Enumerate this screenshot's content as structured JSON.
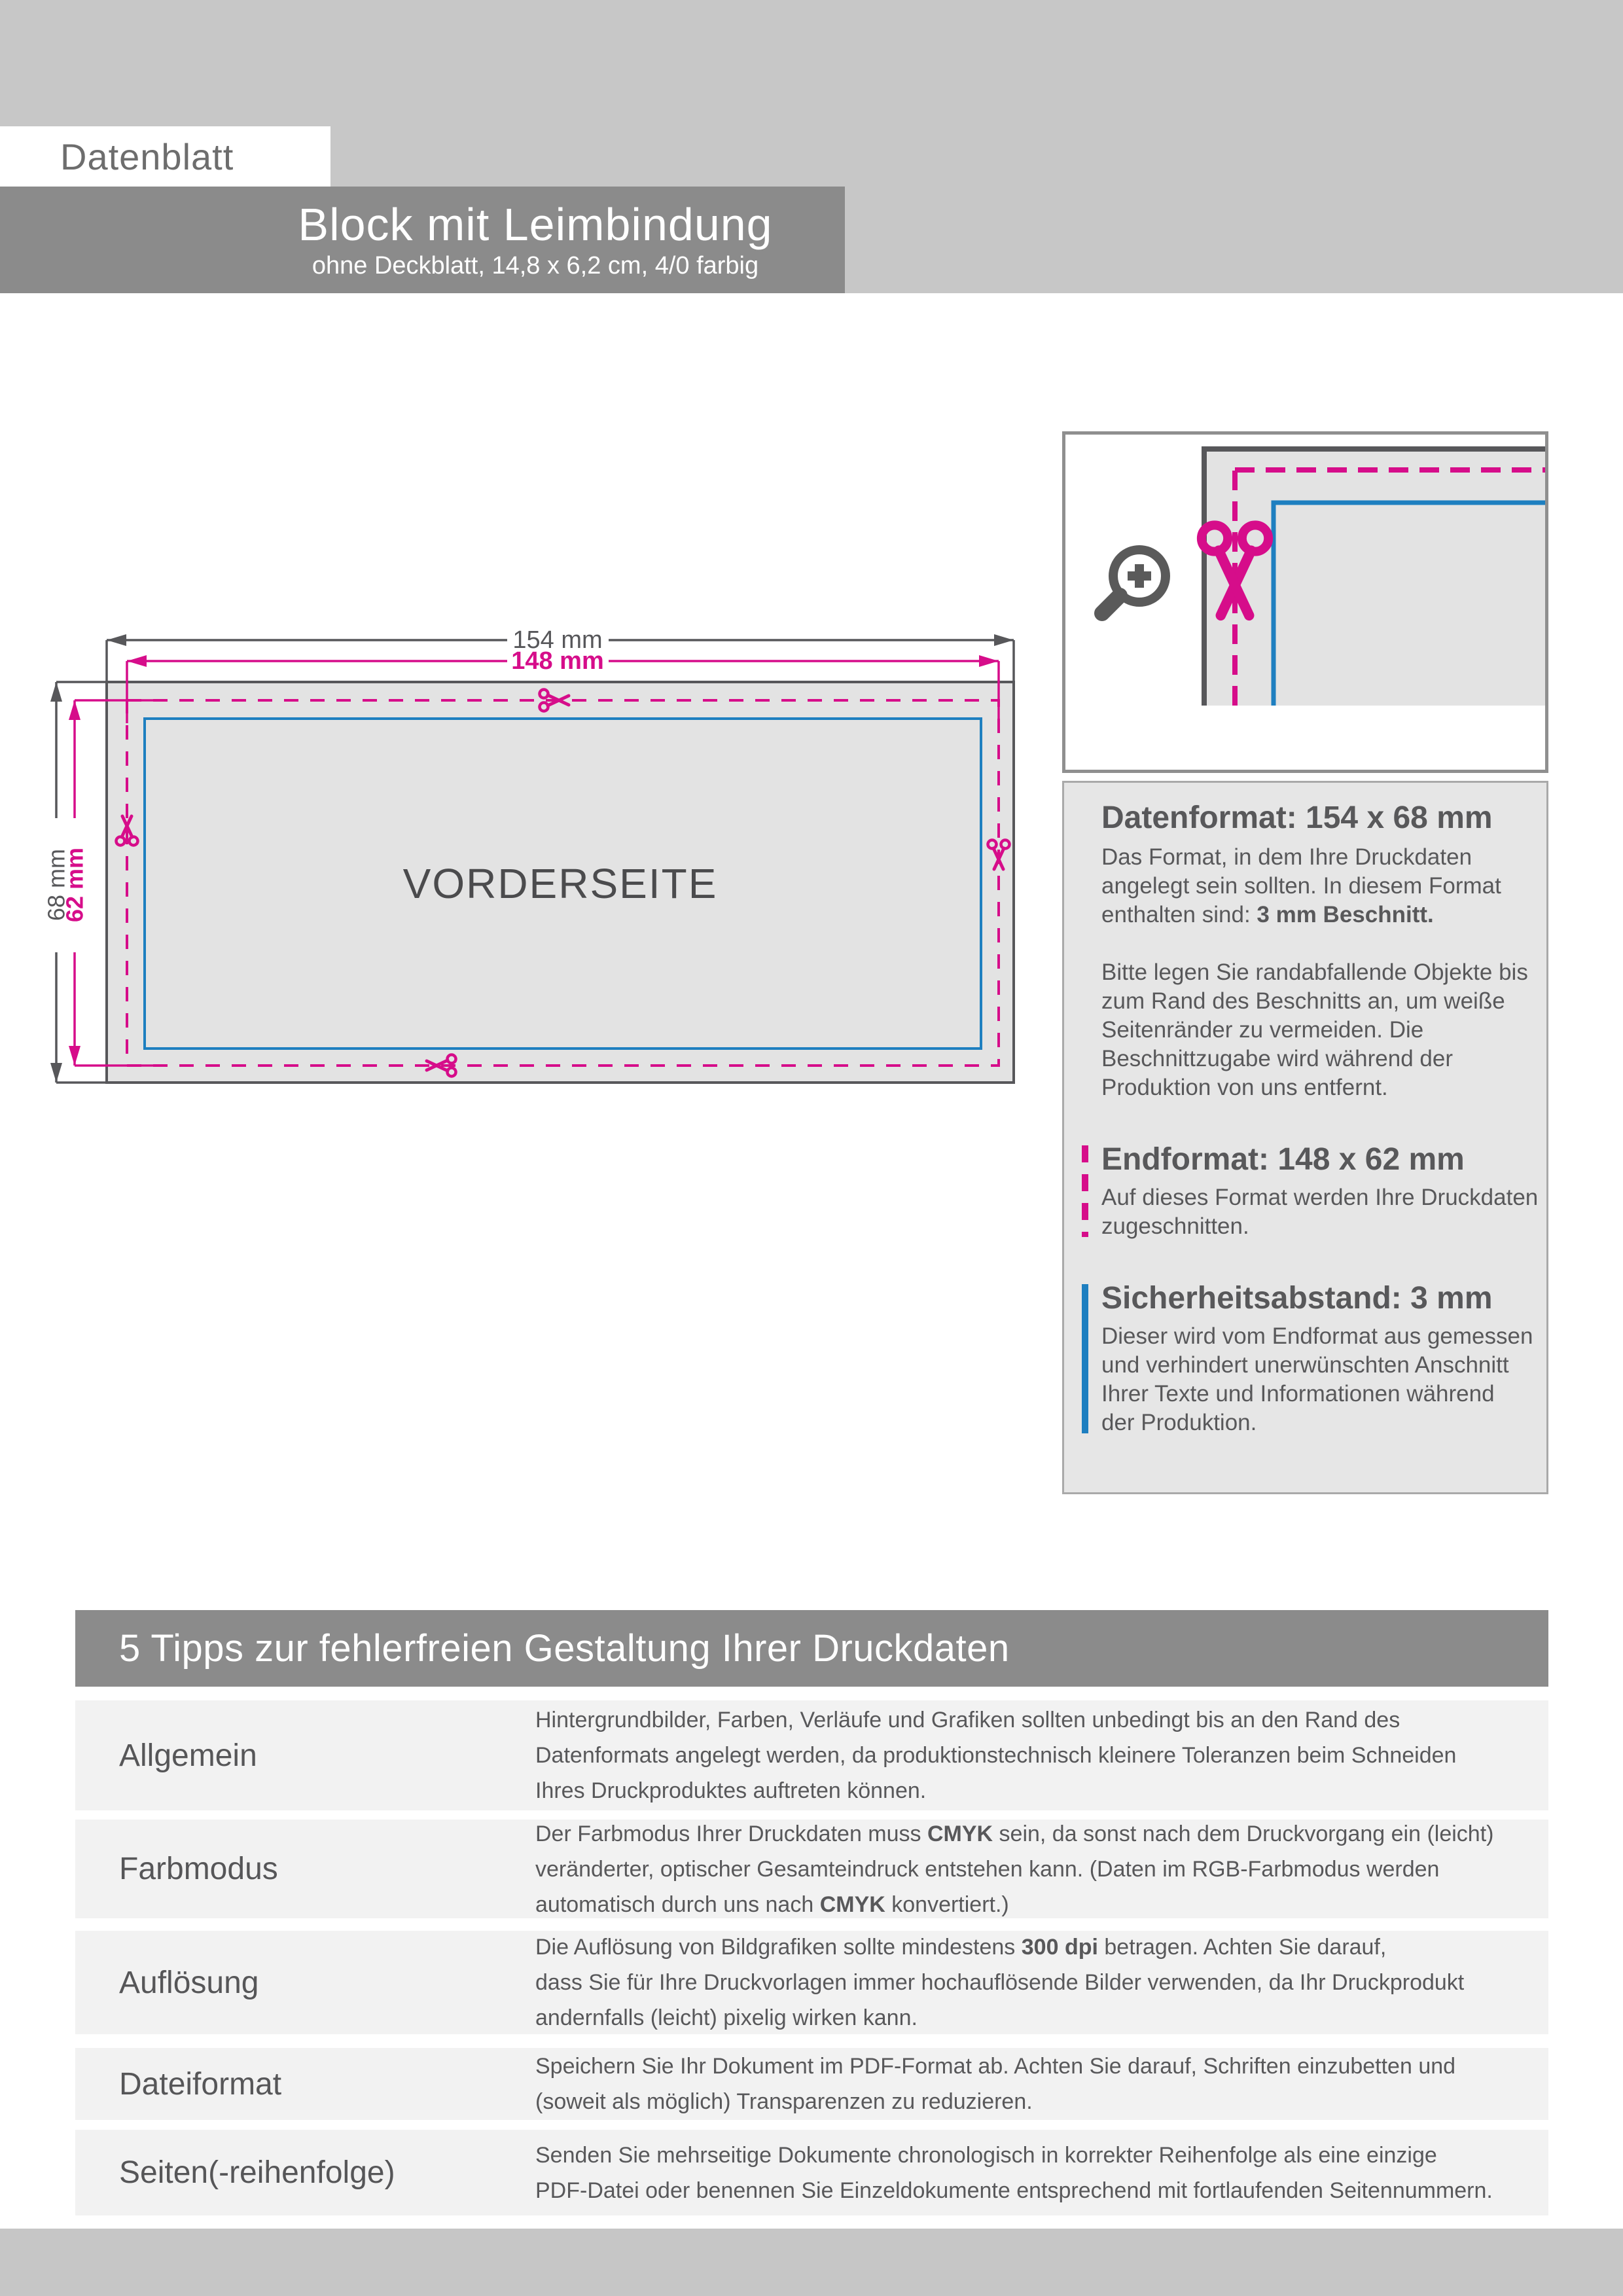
{
  "colors": {
    "magenta": "#d60d8a",
    "blue": "#1e7fc0",
    "dark_gray_text": "#58585a",
    "banner_gray": "#8b8b8b",
    "top_block_gray": "#c7c7c7",
    "panel_gray": "#e6e6e6",
    "diagram_fill": "#e3e3e3",
    "row_gray": "#f2f2f2",
    "footer_gray": "#c6c6c6"
  },
  "header": {
    "datenblatt": "Datenblatt",
    "title": "Block mit Leimbindung",
    "subtitle": "ohne Deckblatt, 14,8 x 6,2 cm, 4/0 farbig"
  },
  "diagram": {
    "front_label": "VORDERSEITE",
    "dims": {
      "outer_w": "154 mm",
      "inner_w": "148 mm",
      "outer_h": "68 mm",
      "inner_h": "62 mm"
    }
  },
  "info": {
    "datenformat": {
      "title": "Datenformat: 154 x 68 mm",
      "body1": [
        [
          {
            "t": "Das Format, in dem Ihre Druckdaten"
          }
        ],
        [
          {
            "t": "angelegt sein sollten. In diesem Format"
          }
        ],
        [
          {
            "t": "enthalten sind: "
          },
          {
            "t": "3 mm Beschnitt.",
            "b": true
          }
        ]
      ],
      "body2": [
        [
          {
            "t": "Bitte legen Sie randabfallende Objekte bis"
          }
        ],
        [
          {
            "t": "zum Rand des Beschnitts an, um weiße"
          }
        ],
        [
          {
            "t": "Seitenränder zu vermeiden. Die"
          }
        ],
        [
          {
            "t": "Beschnittzugabe wird während der"
          }
        ],
        [
          {
            "t": "Produktion von uns entfernt."
          }
        ]
      ]
    },
    "endformat": {
      "title": "Endformat: 148 x 62 mm",
      "body": [
        [
          {
            "t": "Auf dieses Format werden Ihre Druckdaten"
          }
        ],
        [
          {
            "t": "zugeschnitten."
          }
        ]
      ]
    },
    "sicherheit": {
      "title": "Sicherheitsabstand: 3 mm",
      "body": [
        [
          {
            "t": "Dieser wird vom Endformat aus gemessen"
          }
        ],
        [
          {
            "t": "und verhindert unerwünschten Anschnitt"
          }
        ],
        [
          {
            "t": "Ihrer Texte und Informationen während"
          }
        ],
        [
          {
            "t": "der Produktion."
          }
        ]
      ]
    }
  },
  "tips": {
    "title": "5 Tipps zur fehlerfreien Gestaltung Ihrer Druckdaten",
    "rows": [
      {
        "label": "Allgemein",
        "lines": [
          [
            {
              "t": "Hintergrundbilder, Farben, Verläufe und Grafiken sollten unbedingt bis an den Rand des"
            }
          ],
          [
            {
              "t": "Datenformats angelegt werden, da produktionstechnisch kleinere Toleranzen beim Schneiden"
            }
          ],
          [
            {
              "t": "Ihres Druckproduktes auftreten können."
            }
          ]
        ]
      },
      {
        "label": "Farbmodus",
        "lines": [
          [
            {
              "t": "Der Farbmodus Ihrer Druckdaten muss "
            },
            {
              "t": "CMYK",
              "b": true
            },
            {
              "t": " sein, da sonst nach dem Druckvorgang ein (leicht)"
            }
          ],
          [
            {
              "t": "veränderter, optischer Gesamteindruck entstehen kann. (Daten im RGB-Farbmodus werden"
            }
          ],
          [
            {
              "t": "automatisch durch uns nach "
            },
            {
              "t": "CMYK",
              "b": true
            },
            {
              "t": " konvertiert.)"
            }
          ]
        ]
      },
      {
        "label": "Auflösung",
        "lines": [
          [
            {
              "t": "Die Auflösung von Bildgrafiken sollte mindestens "
            },
            {
              "t": "300 dpi",
              "b": true
            },
            {
              "t": " betragen. Achten Sie darauf,"
            }
          ],
          [
            {
              "t": "dass Sie für Ihre Druckvorlagen immer hochauflösende Bilder verwenden, da Ihr Druckprodukt"
            }
          ],
          [
            {
              "t": "andernfalls (leicht) pixelig wirken kann."
            }
          ]
        ]
      },
      {
        "label": "Dateiformat",
        "lines": [
          [
            {
              "t": "Speichern Sie Ihr Dokument im PDF-Format ab. Achten Sie darauf, Schriften einzubetten und"
            }
          ],
          [
            {
              "t": "(soweit als möglich) Transparenzen zu reduzieren."
            }
          ]
        ]
      },
      {
        "label": "Seiten(-reihenfolge)",
        "lines": [
          [
            {
              "t": "Senden Sie mehrseitige Dokumente chronologisch in korrekter Reihenfolge als eine einzige"
            }
          ],
          [
            {
              "t": "PDF-Datei oder benennen Sie Einzeldokumente entsprechend mit fortlaufenden Seitennummern."
            }
          ]
        ]
      }
    ]
  }
}
